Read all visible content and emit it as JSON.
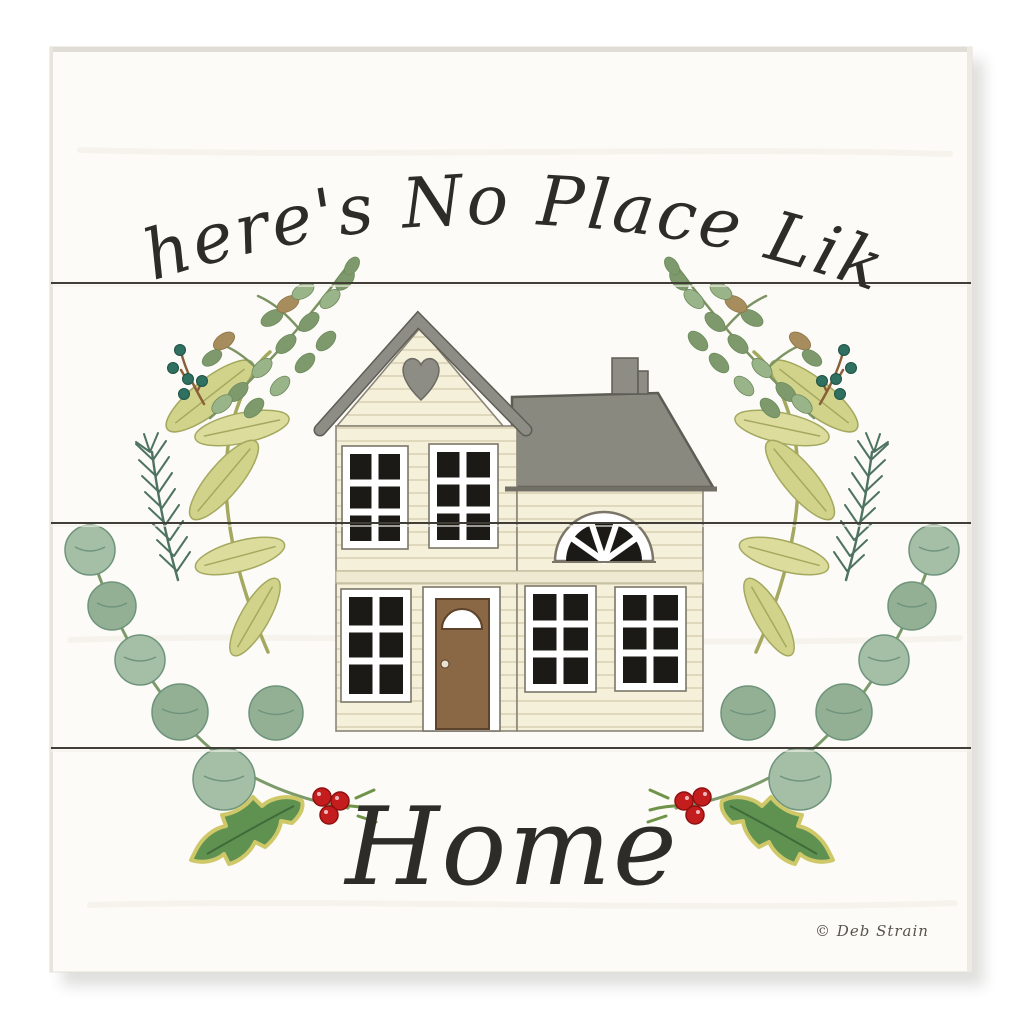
{
  "artwork": {
    "top_text": "There's No Place Like",
    "bottom_text": "Home",
    "signature": "© Deb Strain"
  },
  "palette": {
    "page_bg": "#ffffff",
    "board": "#fcfbf7",
    "board_edge": "#e2dfd6",
    "plank_seam": "#403e37",
    "lettering": "#2d2c28",
    "signature_ink": "#57544d",
    "house_wall": "#f5f0da",
    "siding_line": "#d8d1b2",
    "wall_outline": "#8b8578",
    "roof_gray": "#8e8d85",
    "roof_edge": "#5e5d55",
    "window_pane": "#1b1a17",
    "window_frame": "#ffffff",
    "door_brown": "#8a6845",
    "door_outline": "#5c432a",
    "bay_green": "#d2d38a",
    "bay_outline": "#a4a95f",
    "boxwood_green": "#7e9a6c",
    "boxwood_light": "#9ab489",
    "boxwood_brown": "#a78c5e",
    "eucalyptus_green": "#93b095",
    "eucalyptus_outline": "#6f947c",
    "holly_green": "#5f9150",
    "holly_edge": "#cfc868",
    "pine_green": "#4e7361",
    "berry_teal": "#2f7060",
    "berry_red": "#c41d1d",
    "berry_red_dark": "#8f1010",
    "stem_green": "#7c9a6a",
    "stem_brown": "#8a5f3a"
  }
}
